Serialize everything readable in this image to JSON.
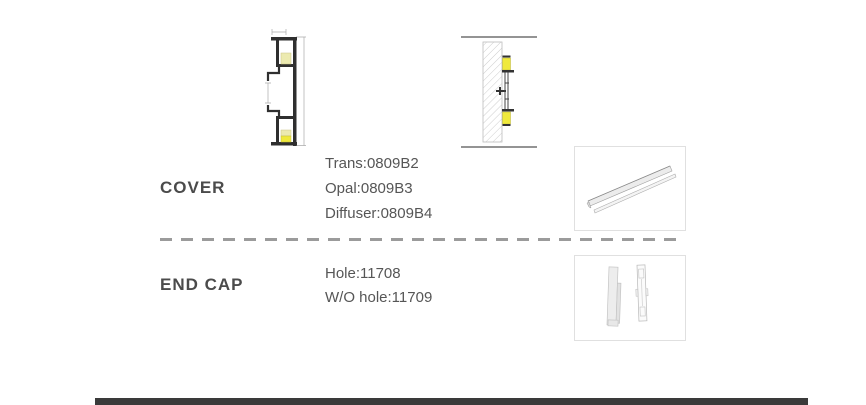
{
  "page": {
    "background": "#ffffff",
    "divider_color": "#9b9b9b",
    "footer_bar_color": "#3a3a3a",
    "drawing_line_color": "#2f2f2f",
    "led_yellow_pale": "#eceab0",
    "led_yellow_bright": "#efe93c"
  },
  "figures": {
    "cross_section": "profile-cross-section-drawing",
    "installation": "wall-mount-installation-drawing",
    "cover_photo": "cover-profile-render",
    "end_cap_photo": "end-cap-render"
  },
  "sections": [
    {
      "id": "cover",
      "label": "COVER",
      "specs": [
        "Trans:0809B2",
        "Opal:0809B3",
        "Diffuser:0809B4"
      ]
    },
    {
      "id": "end_cap",
      "label": "END CAP",
      "specs": [
        "Hole:11708",
        "W/O hole:11709"
      ]
    }
  ]
}
